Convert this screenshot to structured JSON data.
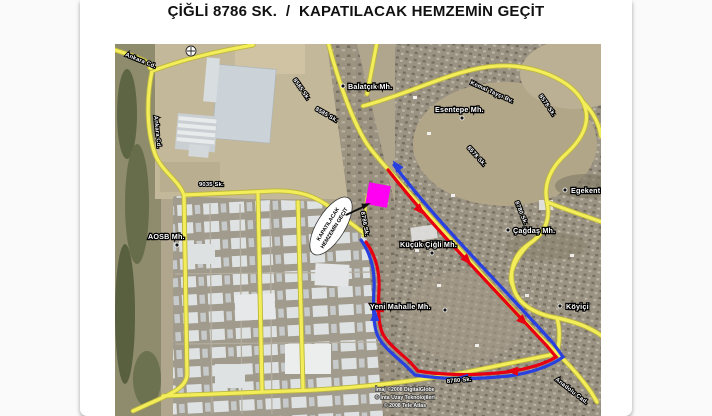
{
  "title": "ÇİĞLİ 8786 SK.  /  KAPATILACAK HEMZEMİN GEÇİT",
  "map": {
    "callout": {
      "line1": "KAPATILACAK",
      "line2": "HEMZEMİN GEÇİT"
    },
    "colors": {
      "road_yellow": "#f3ed5a",
      "route_red": "#e60011",
      "route_blue": "#2840df",
      "marker_magenta": "#ff00f2"
    },
    "neighborhoods": [
      {
        "label": "Balatçık Mh."
      },
      {
        "label": "Esentepe Mh."
      },
      {
        "label": "AOSB Mh."
      },
      {
        "label": "Küçük Çiğli Mh."
      },
      {
        "label": "Yeni Mahalle Mh."
      },
      {
        "label": "Çağdaş Mh."
      },
      {
        "label": "Egekent"
      },
      {
        "label": "Köyiçi"
      }
    ],
    "streets": [
      {
        "label": "Ankara Cd."
      },
      {
        "label": "Ankara Cd."
      },
      {
        "label": "9035 Sk."
      },
      {
        "label": "8585 Sk."
      },
      {
        "label": "8585 Sk."
      },
      {
        "label": "Kemal Tayçı Bv."
      },
      {
        "label": "8578 Sk."
      },
      {
        "label": "8578 Sk."
      },
      {
        "label": "8786 Sk."
      },
      {
        "label": "8780 Sk."
      },
      {
        "label": "8780 Sk."
      },
      {
        "label": "Anadolu Cad."
      }
    ],
    "credits": [
      "İmaj ©2008 DigitalGlobe",
      "© İnta Uzay Teknolojileri",
      "© 2008 Tele Atlas"
    ]
  }
}
